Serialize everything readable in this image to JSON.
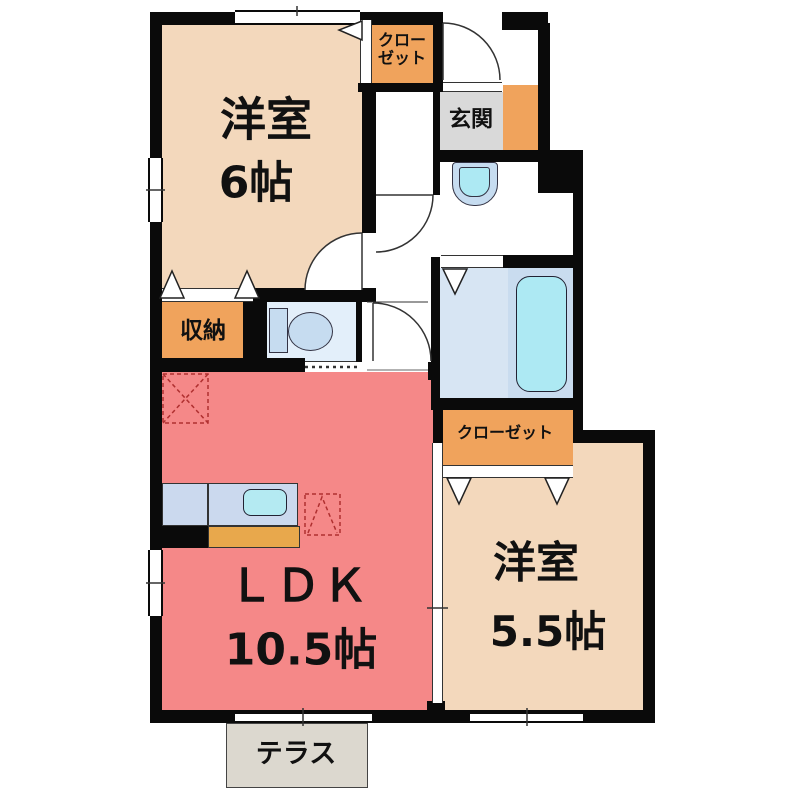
{
  "plan_title": "apartment-floor-plan",
  "rooms": {
    "bedroom_6": {
      "name": "洋室",
      "size": "6帖"
    },
    "ldk": {
      "name": "ＬＤＫ",
      "size": "10.5帖"
    },
    "bedroom_55": {
      "name": "洋室",
      "size": "5.5帖"
    },
    "closet_top": {
      "name_line1": "クロー",
      "name_line2": "ゼット"
    },
    "closet_bottom": {
      "name": "クローゼット"
    },
    "storage": {
      "name": "収納"
    },
    "entrance": {
      "name": "玄関"
    },
    "terrace": {
      "name": "テラス"
    }
  },
  "colors": {
    "room_beige": "#F3D8BC",
    "ldk_pink": "#F58888",
    "closet_orange": "#F0A35C",
    "cabinet_orange": "#E8A84C",
    "entrance_gray": "#D9D9D9",
    "water_blue": "#C6DCF0",
    "fixture_cyan": "#ADE9F3",
    "bath_floor": "#D7E5F3",
    "toilet_floor": "#E3EFFA",
    "counter_blue": "#CBD9EE",
    "terrace_gray": "#DCD8CF",
    "wall_black": "#0A0A0A",
    "marker_red": "#B03030"
  }
}
